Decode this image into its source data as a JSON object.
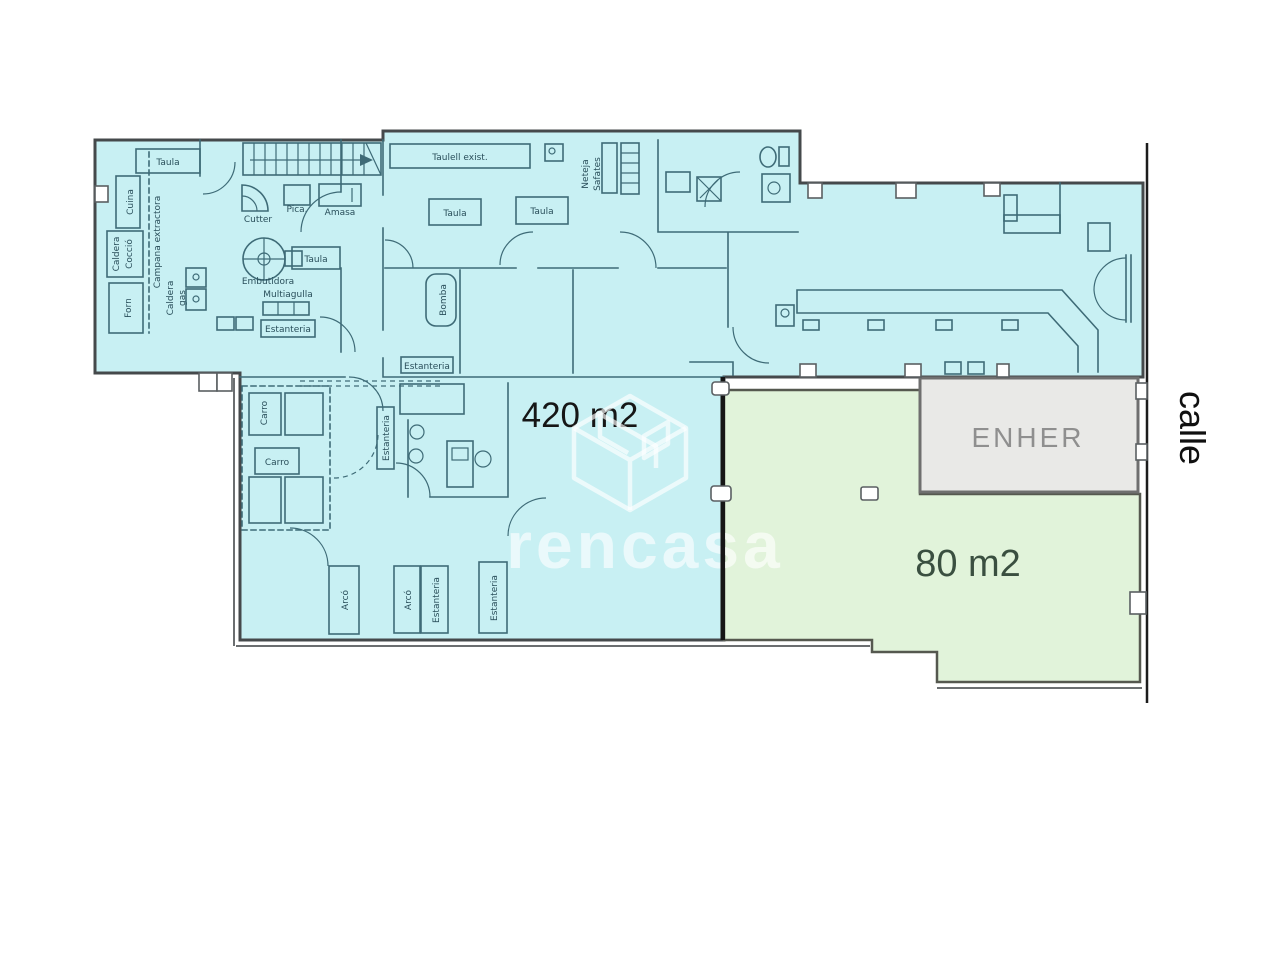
{
  "colors": {
    "background": "#ffffff",
    "zone_main_fill": "#c8f0f3",
    "zone_secondary_fill": "#e1f3da",
    "enher_fill": "#e9e9e7",
    "outer_wall": "#45494b",
    "inner_line": "#3e6b77",
    "label_ink": "#2a4f5b",
    "divider": "#161616",
    "area_main_text": "#161616",
    "area_secondary_text": "#3a4f40",
    "enher_text": "#8f8f8f",
    "street_text": "#101010",
    "watermark": "rgba(255,255,255,0.62)"
  },
  "areas": {
    "main": "420 m2",
    "secondary": "80 m2"
  },
  "rooms": {
    "company_room": "ENHER"
  },
  "street": "calle",
  "watermark_brand": "rencasa",
  "labels": {
    "taula": "Taula",
    "cuina": "Cuina",
    "caldera": "Caldera",
    "coccio": "Cocció",
    "forn": "Forn",
    "campana_extractora": "Campana extractora",
    "gas": "gas",
    "cutter": "Cutter",
    "pica": "Pica.",
    "amasa": "Amasa",
    "embutidora": "Embutidora",
    "multiagulla": "Multiagulla",
    "estanteria": "Estanteria",
    "taulell_exist": "Taulell exist.",
    "neteja": "Neteja",
    "safates": "Safates",
    "bomba": "Bomba",
    "carro": "Carro",
    "arco": "Arcó"
  }
}
